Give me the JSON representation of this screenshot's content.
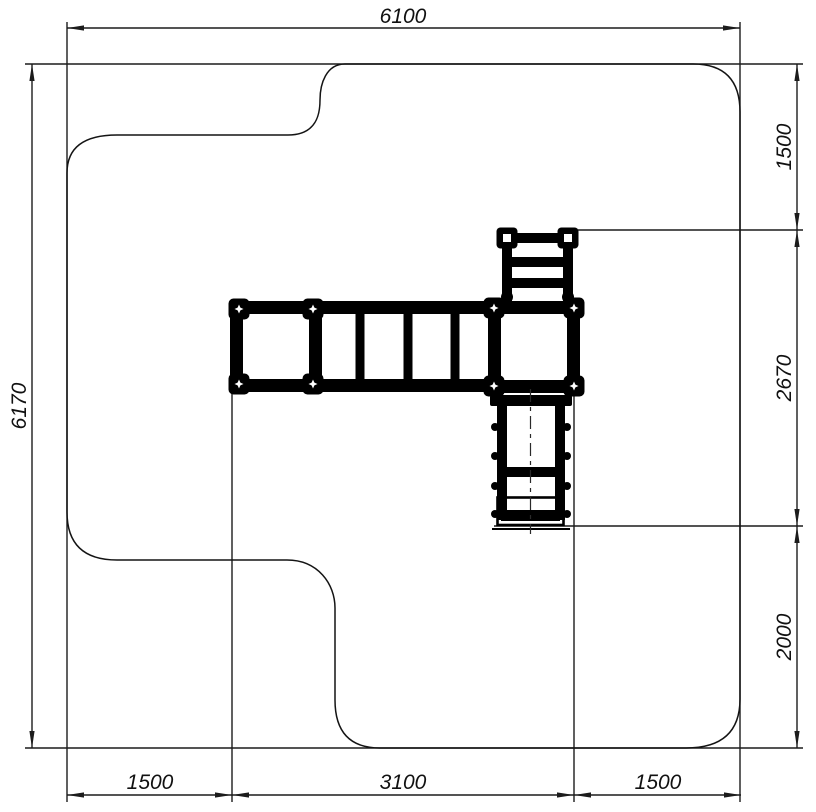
{
  "dimensions": {
    "top": "6100",
    "left": "6170",
    "right": [
      "1500",
      "2670",
      "2000"
    ],
    "bottom": [
      "1500",
      "3100",
      "1500"
    ]
  }
}
